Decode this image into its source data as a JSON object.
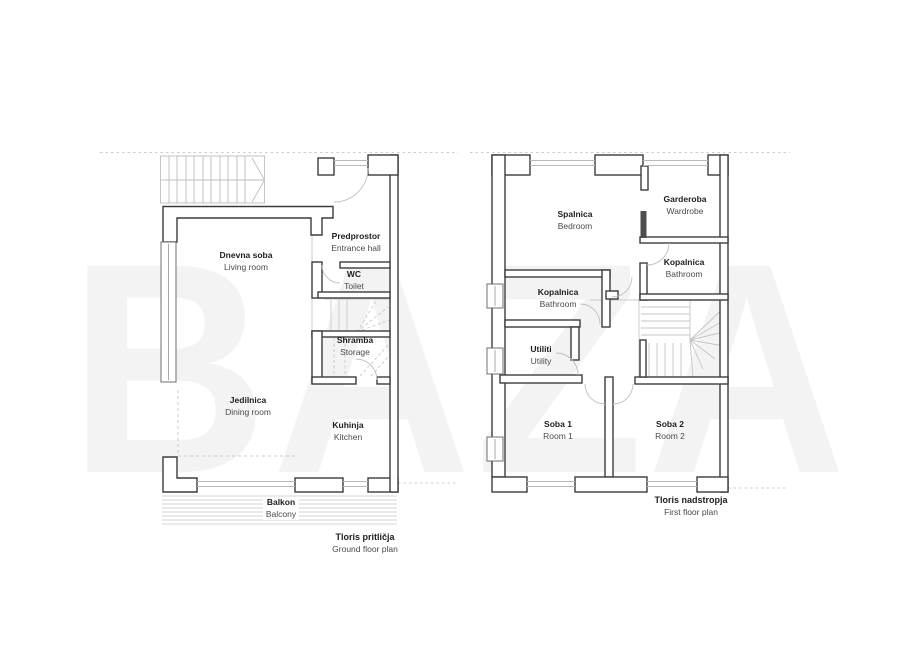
{
  "watermark": "BAZA",
  "colors": {
    "wall_outline": "#3c3c3c",
    "thin_line": "#c2c2c2",
    "text_primary": "#1d1d1d",
    "text_secondary": "#4a4a4a",
    "watermark": "#f3f3f3"
  },
  "ground_floor": {
    "title_sl": "Tloris pritličja",
    "title_en": "Ground floor plan",
    "rooms": {
      "living": {
        "sl": "Dnevna soba",
        "en": "Living room"
      },
      "entrance": {
        "sl": "Predprostor",
        "en": "Entrance hall"
      },
      "wc": {
        "sl": "WC",
        "en": "Toilet"
      },
      "storage": {
        "sl": "Shramba",
        "en": "Storage"
      },
      "dining": {
        "sl": "Jedilnica",
        "en": "Dining room"
      },
      "kitchen": {
        "sl": "Kuhinja",
        "en": "Kitchen"
      },
      "balcony": {
        "sl": "Balkon",
        "en": "Balcony"
      }
    }
  },
  "first_floor": {
    "title_sl": "Tloris nadstropja",
    "title_en": "First floor plan",
    "rooms": {
      "bedroom": {
        "sl": "Spalnica",
        "en": "Bedroom"
      },
      "wardrobe": {
        "sl": "Garderoba",
        "en": "Wardrobe"
      },
      "bathroom_small": {
        "sl": "Kopalnica",
        "en": "Bathroom"
      },
      "bathroom_main": {
        "sl": "Kopalnica",
        "en": "Bathroom"
      },
      "utility": {
        "sl": "Utiliti",
        "en": "Utility"
      },
      "room1": {
        "sl": "Soba 1",
        "en": "Room 1"
      },
      "room2": {
        "sl": "Soba 2",
        "en": "Room 2"
      }
    }
  }
}
